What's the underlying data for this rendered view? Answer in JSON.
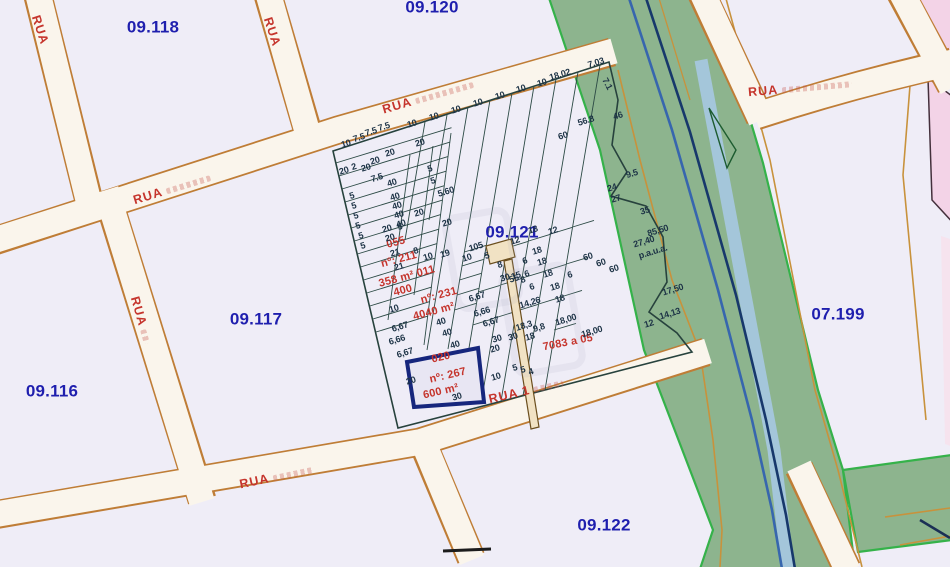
{
  "map": {
    "region_labels": [
      {
        "label": "09.118",
        "x": 153,
        "y": 27
      },
      {
        "label": "09.120",
        "x": 432,
        "y": 7
      },
      {
        "label": "09.117",
        "x": 256,
        "y": 319
      },
      {
        "label": "09.116",
        "x": 52,
        "y": 391
      },
      {
        "label": "09.121",
        "x": 512,
        "y": 232
      },
      {
        "label": "09.122",
        "x": 604,
        "y": 525
      },
      {
        "label": "07.199",
        "x": 838,
        "y": 314
      }
    ],
    "street_labels": [
      {
        "label": "RUA",
        "x": 40,
        "y": 30,
        "rot": 72,
        "scribble": 0
      },
      {
        "label": "RUA",
        "x": 272,
        "y": 32,
        "rot": 72,
        "scribble": 0
      },
      {
        "label": "RUA",
        "x": 172,
        "y": 189,
        "rot": -17,
        "scribble": 46
      },
      {
        "label": "RUA",
        "x": 428,
        "y": 97,
        "rot": -16,
        "scribble": 60
      },
      {
        "label": "RUA",
        "x": 141,
        "y": 320,
        "rot": 74,
        "scribble": 14
      },
      {
        "label": "RUA",
        "x": 276,
        "y": 477,
        "rot": -12,
        "scribble": 40
      },
      {
        "label": "RUA 1",
        "x": 526,
        "y": 391,
        "rot": -13,
        "scribble": 30
      },
      {
        "label": "RUA",
        "x": 800,
        "y": 88,
        "rot": -5,
        "scribble": 70
      }
    ],
    "red_annotations": [
      {
        "label": "055",
        "x": 396,
        "y": 243
      },
      {
        "label": "nº: 211",
        "x": 399,
        "y": 260
      },
      {
        "label": "358 m² 011",
        "x": 407,
        "y": 277
      },
      {
        "label": "400",
        "x": 403,
        "y": 291
      },
      {
        "label": "nº: 231",
        "x": 439,
        "y": 296
      },
      {
        "label": "4040 m²",
        "x": 434,
        "y": 312
      },
      {
        "label": "020",
        "x": 441,
        "y": 358,
        "rot": -13
      },
      {
        "label": "nº: 267",
        "x": 448,
        "y": 376,
        "rot": -13
      },
      {
        "label": "600 m²",
        "x": 441,
        "y": 392,
        "rot": -13
      },
      {
        "label": "7083 a 05",
        "x": 568,
        "y": 343,
        "rot": -11
      }
    ],
    "selected_parcel": {
      "number": "020",
      "address_no": "nº: 267",
      "area": "600 m²"
    },
    "dimension_labels": {
      "default_rotation": -17,
      "items": [
        [
          "10",
          346,
          144
        ],
        [
          "7.5",
          359,
          138
        ],
        [
          "7.5",
          371,
          132
        ],
        [
          "7.5",
          384,
          127
        ],
        [
          "10",
          412,
          124
        ],
        [
          "10",
          434,
          117
        ],
        [
          "10",
          456,
          110
        ],
        [
          "10",
          478,
          103
        ],
        [
          "10",
          500,
          96
        ],
        [
          "10",
          521,
          89
        ],
        [
          "10",
          542,
          83
        ],
        [
          "18.02",
          560,
          75
        ],
        [
          "7.03",
          596,
          63
        ],
        [
          "7.1",
          607,
          84,
          62
        ],
        [
          "46",
          618,
          116
        ],
        [
          "56.8",
          586,
          121
        ],
        [
          "60",
          563,
          136
        ],
        [
          "9.5",
          632,
          174
        ],
        [
          "24",
          612,
          188
        ],
        [
          "27",
          616,
          199
        ],
        [
          "35",
          645,
          211
        ],
        [
          "85,50",
          658,
          231
        ],
        [
          "27,40",
          644,
          242
        ],
        [
          "p.a.u.a.",
          653,
          252
        ],
        [
          "17,50",
          673,
          290
        ],
        [
          "14,13",
          670,
          314
        ],
        [
          "12",
          649,
          324
        ],
        [
          "18,00",
          592,
          332
        ],
        [
          "18,00",
          566,
          320
        ],
        [
          "60",
          588,
          257
        ],
        [
          "60",
          601,
          263
        ],
        [
          "60",
          614,
          269
        ],
        [
          "20",
          420,
          143
        ],
        [
          "20",
          390,
          153
        ],
        [
          "20",
          375,
          161
        ],
        [
          "2",
          354,
          167
        ],
        [
          "20",
          366,
          168
        ],
        [
          "20",
          344,
          171
        ],
        [
          "7.5",
          377,
          178
        ],
        [
          "40",
          392,
          183
        ],
        [
          "5",
          430,
          169
        ],
        [
          "5",
          433,
          181
        ],
        [
          "5.60",
          446,
          192
        ],
        [
          "40",
          395,
          197
        ],
        [
          "40",
          397,
          206
        ],
        [
          "40",
          399,
          215
        ],
        [
          "40",
          401,
          224
        ],
        [
          "5",
          352,
          196
        ],
        [
          "5",
          354,
          206
        ],
        [
          "5",
          356,
          216
        ],
        [
          "5",
          358,
          226
        ],
        [
          "20",
          419,
          213
        ],
        [
          "20",
          447,
          223
        ],
        [
          "5",
          400,
          227
        ],
        [
          "20",
          387,
          229
        ],
        [
          "5",
          361,
          236
        ],
        [
          "5",
          363,
          246
        ],
        [
          "20",
          390,
          238
        ],
        [
          "21",
          395,
          253
        ],
        [
          "8",
          416,
          251
        ],
        [
          "10",
          428,
          257
        ],
        [
          "19",
          445,
          254
        ],
        [
          "10",
          467,
          258
        ],
        [
          "21",
          399,
          267
        ],
        [
          "105",
          476,
          247
        ],
        [
          "5",
          487,
          256
        ],
        [
          "12",
          515,
          241
        ],
        [
          "12",
          553,
          231
        ],
        [
          "18",
          533,
          230
        ],
        [
          "8",
          500,
          265
        ],
        [
          "15",
          516,
          276
        ],
        [
          "6",
          527,
          274
        ],
        [
          "18",
          548,
          274
        ],
        [
          "6",
          570,
          275
        ],
        [
          "18",
          537,
          251
        ],
        [
          "6",
          525,
          261
        ],
        [
          "18",
          542,
          262
        ],
        [
          "6",
          532,
          287
        ],
        [
          "18",
          555,
          287
        ],
        [
          "18",
          560,
          299
        ],
        [
          "14,26",
          530,
          303
        ],
        [
          "30",
          505,
          278
        ],
        [
          "55",
          514,
          279
        ],
        [
          "8",
          523,
          280
        ],
        [
          "18,3",
          524,
          326
        ],
        [
          "9,8",
          539,
          328
        ],
        [
          "30",
          497,
          339
        ],
        [
          "30",
          513,
          337
        ],
        [
          "18",
          530,
          337
        ],
        [
          "20",
          495,
          349
        ],
        [
          "10",
          394,
          309
        ],
        [
          "40",
          441,
          322
        ],
        [
          "6,67",
          477,
          297
        ],
        [
          "6,66",
          482,
          312
        ],
        [
          "6,67",
          491,
          322
        ],
        [
          "6,67",
          400,
          327
        ],
        [
          "6,66",
          397,
          340
        ],
        [
          "6,67",
          405,
          353
        ],
        [
          "40",
          447,
          333
        ],
        [
          "40",
          455,
          345
        ],
        [
          "20",
          411,
          381
        ],
        [
          "30",
          457,
          397
        ],
        [
          "10",
          496,
          377
        ],
        [
          "5",
          515,
          368
        ],
        [
          "5",
          523,
          370
        ],
        [
          "4",
          531,
          372
        ]
      ]
    },
    "colors": {
      "background": "#efedf7",
      "street_fill": "#faf5ec",
      "street_border": "#bf7d36",
      "parcel_line": "#2c4a45",
      "block_label": "#1f1fae",
      "street_label": "#c5342c",
      "annotation_red": "#c5342c",
      "dimension_text": "#1d3346",
      "green_area": "#8db48e",
      "green_border": "#35b24a",
      "river_blue": "#3766ae",
      "river_dark": "#17386b",
      "water_channel": "#a4c6da",
      "pink_area": "#f3d3e7",
      "highlight_parcel": "#16267d",
      "tan_parcel": "#f1e2c4"
    }
  }
}
